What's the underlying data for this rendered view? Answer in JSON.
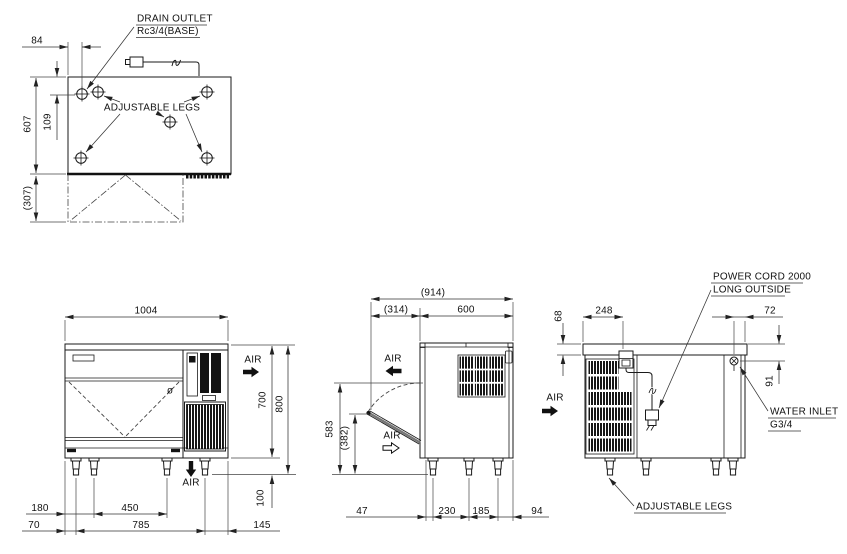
{
  "drawing_type": "ice machine installation drawing",
  "colors": {
    "line": "#1a1a1a",
    "background": "#ffffff"
  },
  "views": {
    "top": {
      "labels": {
        "drain_line1": "DRAIN OUTLET",
        "drain_line2": "Rc3/4(BASE)",
        "adjustable_legs": "ADJUSTABLE LEGS"
      },
      "dims": {
        "drain_offset_x": "84",
        "depth": "607",
        "drain_offset_y": "109",
        "door_projection": "(307)"
      }
    },
    "front": {
      "labels": {
        "air_side": "AIR",
        "air_bottom": "AIR",
        "diameter_mark": "ø"
      },
      "dims": {
        "width": "1004",
        "body_height": "700",
        "total_height": "800",
        "leg_height": "100",
        "leg2_offset": "180",
        "leg_spacing_mid": "450",
        "leg1_offset": "70",
        "leg_span": "785",
        "right_margin": "145"
      }
    },
    "side": {
      "labels": {
        "air_top": "AIR",
        "air_door": "AIR",
        "air_rear": "AIR"
      },
      "dims": {
        "total_depth": "(914)",
        "door_swing": "(314)",
        "depth": "600",
        "opening_height": "583",
        "door_open_height": "(382)",
        "leg_front_offset": "47",
        "leg_spacing_front": "230",
        "leg_spacing_rear": "185",
        "leg_rear_offset": "94"
      }
    },
    "rear": {
      "labels": {
        "power_cord_line1": "POWER CORD 2000",
        "power_cord_line2": "LONG OUTSIDE",
        "water_inlet_line1": "WATER INLET",
        "water_inlet_line2": "G3/4",
        "adjustable_legs": "ADJUSTABLE LEGS"
      },
      "dims": {
        "top_band_height": "68",
        "grille_width": "248",
        "inlet_offset": "72",
        "inlet_depth": "91"
      }
    }
  }
}
